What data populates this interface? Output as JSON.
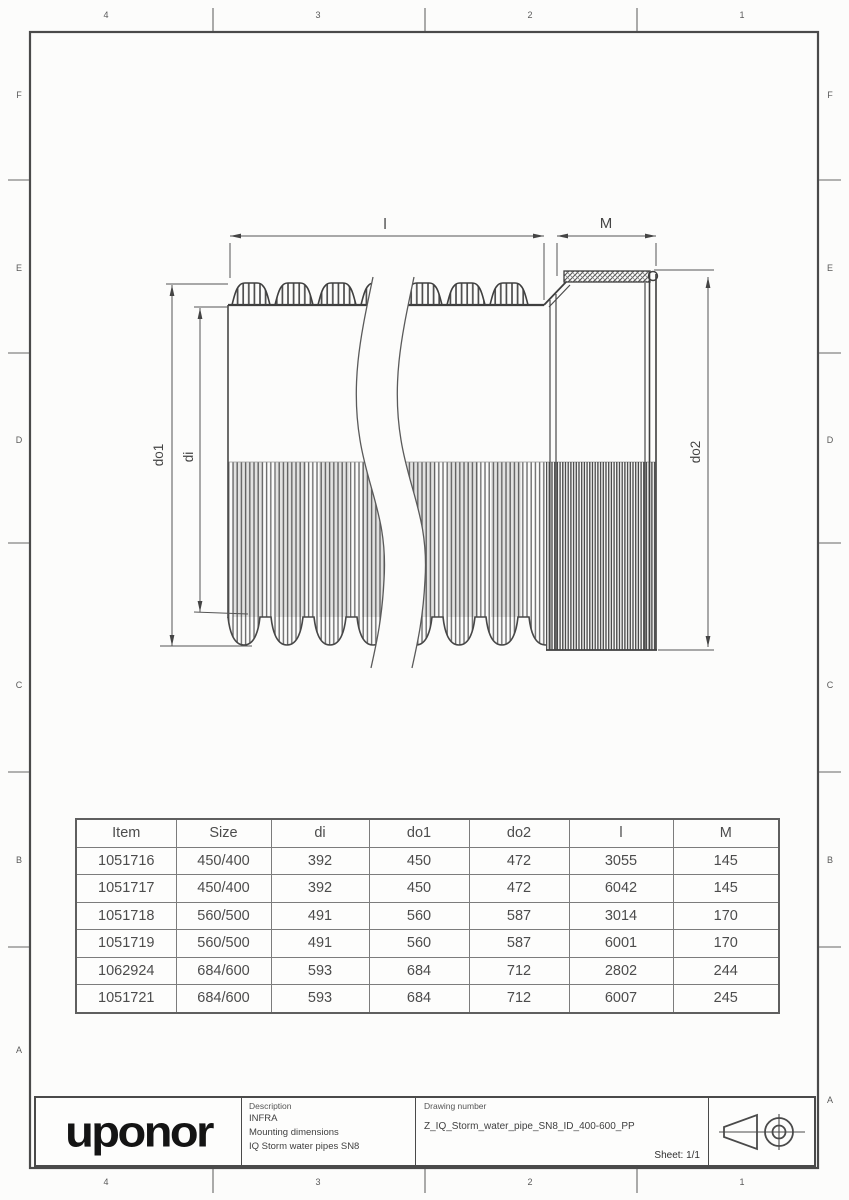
{
  "frame": {
    "cols": [
      "4",
      "3",
      "2",
      "1"
    ],
    "rows": [
      "F",
      "E",
      "D",
      "C",
      "B",
      "A"
    ]
  },
  "drawing": {
    "labels": {
      "l": "l",
      "m": "M",
      "do1": "do1",
      "di": "di",
      "do2": "do2"
    }
  },
  "table": {
    "headers": [
      "Item",
      "Size",
      "di",
      "do1",
      "do2",
      "l",
      "M"
    ],
    "rows": [
      [
        "1051716",
        "450/400",
        "392",
        "450",
        "472",
        "3055",
        "145"
      ],
      [
        "1051717",
        "450/400",
        "392",
        "450",
        "472",
        "6042",
        "145"
      ],
      [
        "1051718",
        "560/500",
        "491",
        "560",
        "587",
        "3014",
        "170"
      ],
      [
        "1051719",
        "560/500",
        "491",
        "560",
        "587",
        "6001",
        "170"
      ],
      [
        "1062924",
        "684/600",
        "593",
        "684",
        "712",
        "2802",
        "244"
      ],
      [
        "1051721",
        "684/600",
        "593",
        "684",
        "712",
        "6007",
        "245"
      ]
    ]
  },
  "title_block": {
    "logo": "uponor",
    "description_label": "Description",
    "description_lines": [
      "INFRA",
      "Mounting dimensions",
      "IQ Storm water pipes SN8"
    ],
    "drawing_number_label": "Drawing number",
    "drawing_number": "Z_IQ_Storm_water_pipe_SN8_ID_400-600_PP",
    "sheet_label": "Sheet: 1/1"
  }
}
